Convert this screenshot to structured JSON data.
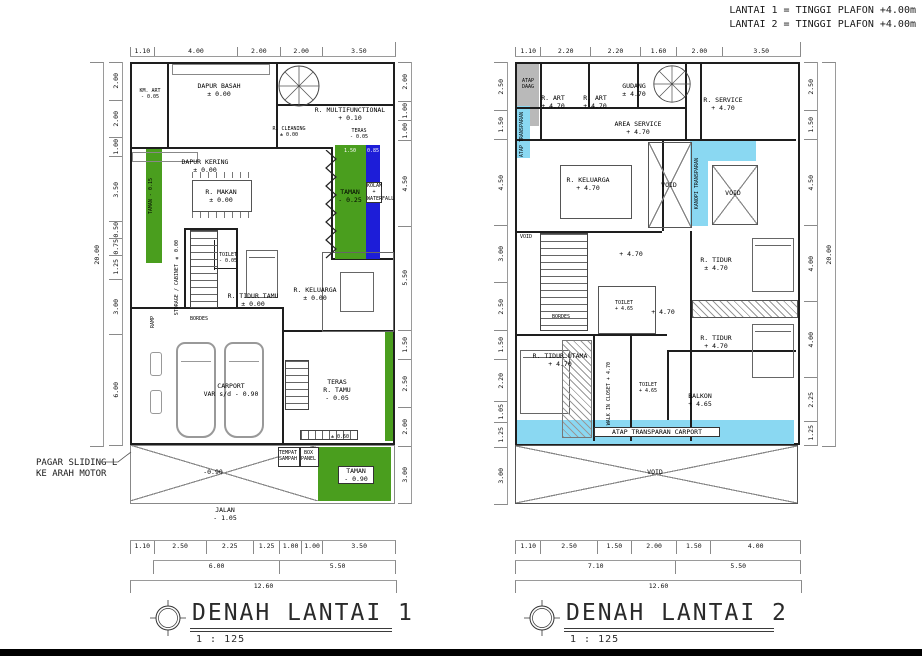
{
  "notes": {
    "line1": "LANTAI 1 =  TINGGI PLAFON  +4.00m",
    "line2": "LANTAI 2 =  TINGGI PLAFON  +4.00m"
  },
  "plan1": {
    "title": "DENAH LANTAI 1",
    "scale": "1 : 125",
    "dims": {
      "top": [
        "1.10",
        "4.00",
        "2.00",
        "2.00",
        "3.50"
      ],
      "left": [
        "2.00",
        "2.00",
        "1.00",
        "3.50",
        "0.50",
        "0.75",
        "1.25",
        "3.00",
        "6.00"
      ],
      "left_total": "20.00",
      "right": [
        "2.00",
        "1.00",
        "1.00",
        "4.50",
        "5.50",
        "1.50",
        "2.50",
        "2.00",
        "3.00"
      ],
      "bottom1": [
        "1.10",
        "2.50",
        "2.25",
        "1.25",
        "1.00",
        "1.00",
        "3.50"
      ],
      "bottom2": [
        "6.00",
        "5.50"
      ],
      "bottom_total": "12.60"
    },
    "rooms": {
      "km_art": {
        "label": "KM. ART",
        "level": "- 0.05"
      },
      "dapur_basah": {
        "label": "DAPUR BASAH",
        "level": "± 0.00"
      },
      "multifunctional": {
        "label": "R. MULTIFUNCTIONAL",
        "level": "+ 0.10"
      },
      "cleaning": {
        "label": "R. CLEANING",
        "level": "± 0.00"
      },
      "teras_samping": {
        "label": "TERAS",
        "level": "- 0.05"
      },
      "dapur_kering": {
        "label": "DAPUR KERING",
        "level": "± 0.00"
      },
      "makan": {
        "label": "R. MAKAN",
        "level": "± 0.00"
      },
      "taman_kiri": {
        "label": "TAMAN",
        "level": "- 0.15"
      },
      "taman_tengah": {
        "label": "TAMAN",
        "level": "- 0.25"
      },
      "kolam": {
        "label": "KOLAM + WATERFALL"
      },
      "storage": {
        "label": "STORAGE / CABINET",
        "level": "± 0.00"
      },
      "toilet": {
        "label": "TOILET",
        "level": "- 0.05"
      },
      "tidur_tamu": {
        "label": "R. TIDUR TAMU",
        "level": "± 0.00"
      },
      "keluarga": {
        "label": "R. KELUARGA",
        "level": "± 0.00"
      },
      "bordes": {
        "label": "BORDES"
      },
      "ramp": {
        "label": "RAMP"
      },
      "carport": {
        "label": "CARPORT",
        "level": "VAR s/d - 0.90"
      },
      "teras_tamu": {
        "label": "TERAS",
        "label2": "R. TAMU",
        "level": "- 0.05"
      },
      "taman_depan": {
        "label": "TAMAN",
        "level": "- 0.90"
      },
      "tempat_sampah": {
        "label": "TEMPAT SAMPAH"
      },
      "box_panel": {
        "label": "BOX PANEL"
      },
      "jalan": {
        "label": "JALAN",
        "level": "- 1.05"
      }
    },
    "labels": {
      "pagar_line1": "PAGAR SLIDING L",
      "pagar_line2": "KE ARAH MOTOR",
      "halaman_level": "-0.90",
      "step_level": "± 0.60",
      "taman_dim": "1.50",
      "kolam_dim": "0.85"
    }
  },
  "plan2": {
    "title": "DENAH LANTAI 2",
    "scale": "1 : 125",
    "dims": {
      "top": [
        "1.10",
        "2.20",
        "2.20",
        "1.60",
        "2.00",
        "3.50"
      ],
      "left": [
        "2.50",
        "1.50",
        "4.50",
        "3.00",
        "2.50",
        "1.50",
        "2.20",
        "1.05",
        "1.25",
        "3.00"
      ],
      "right": [
        "2.50",
        "1.50",
        "4.50",
        "4.00",
        "4.00",
        "2.25",
        "1.25"
      ],
      "right_total": "20.00",
      "bottom1": [
        "1.10",
        "2.50",
        "1.50",
        "2.00",
        "1.50",
        "4.00"
      ],
      "bottom2": [
        "7.10",
        "5.50"
      ],
      "bottom_total": "12.60"
    },
    "rooms": {
      "atap_dag": {
        "label": "ATAP DAAG"
      },
      "atap_kiri": {
        "label": "ATAP TRANSPARAN"
      },
      "art1": {
        "label": "R. ART",
        "level": "+ 4.70"
      },
      "art2": {
        "label": "R. ART",
        "level": "+ 4.70"
      },
      "gudang": {
        "label": "GUDANG",
        "level": "± 4.70"
      },
      "service": {
        "label": "R. SERVICE",
        "level": "+ 4.70"
      },
      "area_service": {
        "label": "AREA SERVICE",
        "level": "+ 4.70"
      },
      "keluarga": {
        "label": "R. KELUARGA",
        "level": "+ 4.70"
      },
      "void_left": {
        "label": "VOID"
      },
      "void_mid": {
        "label": "VOID"
      },
      "void_right": {
        "label": "VOID"
      },
      "kanopi": {
        "label": "KANOPI TRANSPARAN"
      },
      "hall_a": {
        "level": "+ 4.70"
      },
      "hall_b": {
        "level": "+ 4.70"
      },
      "bordes": {
        "label": "BORDES"
      },
      "tidur1": {
        "label": "R. TIDUR",
        "level": "± 4.70"
      },
      "toilet1": {
        "label": "TOILET",
        "level": "+ 4.65"
      },
      "tidur2": {
        "label": "R. TIDUR",
        "level": "+ 4.70"
      },
      "tidur_utama": {
        "label": "R. TIDUR UTAMA",
        "level": "+ 4.70"
      },
      "wic": {
        "label": "WALK IN CLOSET",
        "level": "+ 4.70"
      },
      "toilet2": {
        "label": "TOILET",
        "level": "+ 4.65"
      },
      "balkon": {
        "label": "BALKON",
        "level": "+ 4.65"
      },
      "atap_carport": {
        "label": "ATAP TRANSPARAN CARPORT"
      },
      "void_bottom": {
        "label": "VOID"
      }
    }
  }
}
